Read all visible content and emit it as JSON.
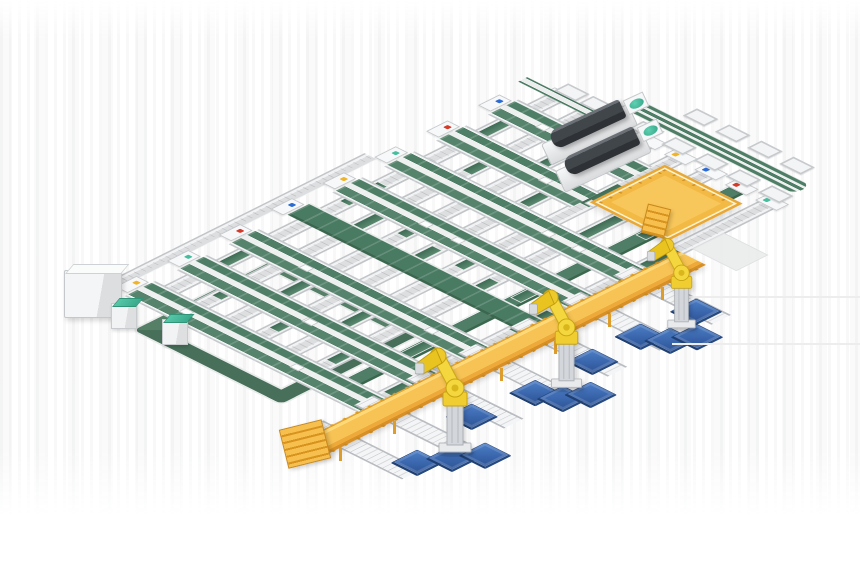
{
  "meta": {
    "description": "Isometric 3D render of an automated conveyor sortation line with overhead walkway, palletizing robots and blue pallets",
    "visible_text": []
  },
  "colors": {
    "background": "#ffffff",
    "belt_green": "#4e7e66",
    "belt_green_dark": "#3c674f",
    "teal_accent": "#46bd9e",
    "conveyor_gray": "#dcdee0",
    "conveyor_frame": "#c2c5c8",
    "walkway_yellow": "#f7c355",
    "walkway_shadow": "#d88f26",
    "robot_yellow": "#f4d63e",
    "pallet_blue": "#3a66ad",
    "pallet_blue_dark": "#2e5494",
    "machine_dark": "#41464b",
    "platform_yellow": "#f8c75b"
  },
  "scene": {
    "iso_matrix": "matrix(0.894,0.447,-0.894,0.447,545,95)",
    "u_lines": [
      {
        "x": 0,
        "y": 0,
        "len": 430
      },
      {
        "x": 34,
        "y": 0,
        "len": 430
      },
      {
        "x": 68,
        "y": 0,
        "len": 430
      },
      {
        "x": 102,
        "y": 0,
        "len": 430
      },
      {
        "x": 136,
        "y": 0,
        "len": 430
      },
      {
        "x": 170,
        "y": 0,
        "len": 430
      },
      {
        "x": 204,
        "y": 0,
        "len": 430,
        "green": true
      },
      {
        "x": 238,
        "y": 0,
        "len": 430
      }
    ],
    "v_lanes": [
      {
        "y": 20,
        "x": -10,
        "len": 150
      },
      {
        "y": 78,
        "x": -10,
        "len": 150
      },
      {
        "y": 136,
        "x": -10,
        "len": 260
      },
      {
        "y": 194,
        "x": -10,
        "len": 260
      },
      {
        "y": 252,
        "x": -10,
        "len": 260,
        "solid": true
      },
      {
        "y": 310,
        "x": -10,
        "len": 260
      },
      {
        "y": 368,
        "x": -10,
        "len": 260
      },
      {
        "y": 426,
        "x": -10,
        "len": 260
      }
    ],
    "spur_conveyors": [
      {
        "y": 142,
        "x": 240,
        "len": 110
      },
      {
        "y": 200,
        "x": 240,
        "len": 110
      },
      {
        "y": 258,
        "x": 240,
        "len": 110
      },
      {
        "y": 316,
        "x": 240,
        "len": 110
      },
      {
        "y": 374,
        "x": 240,
        "len": 110
      },
      {
        "y": 432,
        "x": 240,
        "len": 110
      },
      {
        "y": 488,
        "x": 240,
        "len": 110
      }
    ],
    "walkway": {
      "x": 250,
      "y": 100,
      "w": 30,
      "len": 432
    },
    "walkway_legs": [
      [
        661,
        287
      ],
      [
        608,
        314
      ],
      [
        554,
        341
      ],
      [
        500,
        368
      ],
      [
        447,
        394
      ],
      [
        393,
        421
      ],
      [
        339,
        448
      ]
    ],
    "walkway_stairs": {
      "left": 283,
      "top": 424,
      "w": 44,
      "h": 40,
      "rot": -14
    },
    "loop": {
      "x": 33,
      "y": 333,
      "w": 165,
      "h": 160
    },
    "feed_conveyor": {
      "x": -36,
      "y": 166,
      "w": 14,
      "len": 304
    },
    "trunk": {
      "x": -30,
      "y": -10,
      "len": 95
    },
    "sorter_spur": {
      "x": 58,
      "y": -48,
      "len": 192
    },
    "trays_top": {
      "y": -70,
      "xs": [
        100,
        136,
        172,
        208
      ]
    },
    "trays_bottom": {
      "y": -26,
      "xs": [
        0,
        28,
        84,
        120,
        156,
        192,
        228
      ]
    },
    "end_ramp": {
      "x": 254,
      "y": 54,
      "w": 50,
      "h": 36
    },
    "platform": {
      "x": 145,
      "y": 11,
      "w": 87,
      "h": 84
    },
    "platform_stairs": {
      "left": 644,
      "top": 206,
      "w": 24,
      "h": 30,
      "rot": 14
    },
    "machines": [
      {
        "base": [
          546,
          143
        ],
        "body": [
          552,
          131
        ],
        "disc": [
          626,
          100
        ]
      },
      {
        "base": [
          560,
          170
        ],
        "body": [
          566,
          158
        ],
        "disc": [
          640,
          127
        ]
      }
    ],
    "machine_angle": -25,
    "cabinet_gray": {
      "left": 64,
      "top": 270
    },
    "cabinets_teal": [
      {
        "left": 111,
        "top": 303
      },
      {
        "left": 162,
        "top": 319
      }
    ],
    "robots": [
      {
        "cx": 455,
        "base_y": 456,
        "scale": 1.0
      },
      {
        "cx": 567,
        "base_y": 391,
        "scale": 0.94
      },
      {
        "cx": 681,
        "base_y": 331,
        "scale": 0.86
      }
    ],
    "pallets": [
      {
        "x": 340,
        "y": 483
      },
      {
        "x": 355,
        "y": 459
      },
      {
        "x": 370,
        "y": 437
      },
      {
        "x": 319,
        "y": 401
      },
      {
        "x": 328,
        "y": 339
      },
      {
        "x": 350,
        "y": 330
      },
      {
        "x": 361,
        "y": 310
      },
      {
        "x": 325,
        "y": 272
      },
      {
        "x": 324,
        "y": 217
      },
      {
        "x": 345,
        "y": 205
      },
      {
        "x": 356,
        "y": 186
      },
      {
        "x": 327,
        "y": 158
      }
    ],
    "faint_lines": [
      {
        "left": 688,
        "top": 296,
        "w": 172
      },
      {
        "left": 672,
        "top": 343,
        "w": 188
      }
    ],
    "dot_colors": [
      "#f0b429",
      "#2b6bd4",
      "#d43a2a",
      "#46bd9e"
    ]
  }
}
